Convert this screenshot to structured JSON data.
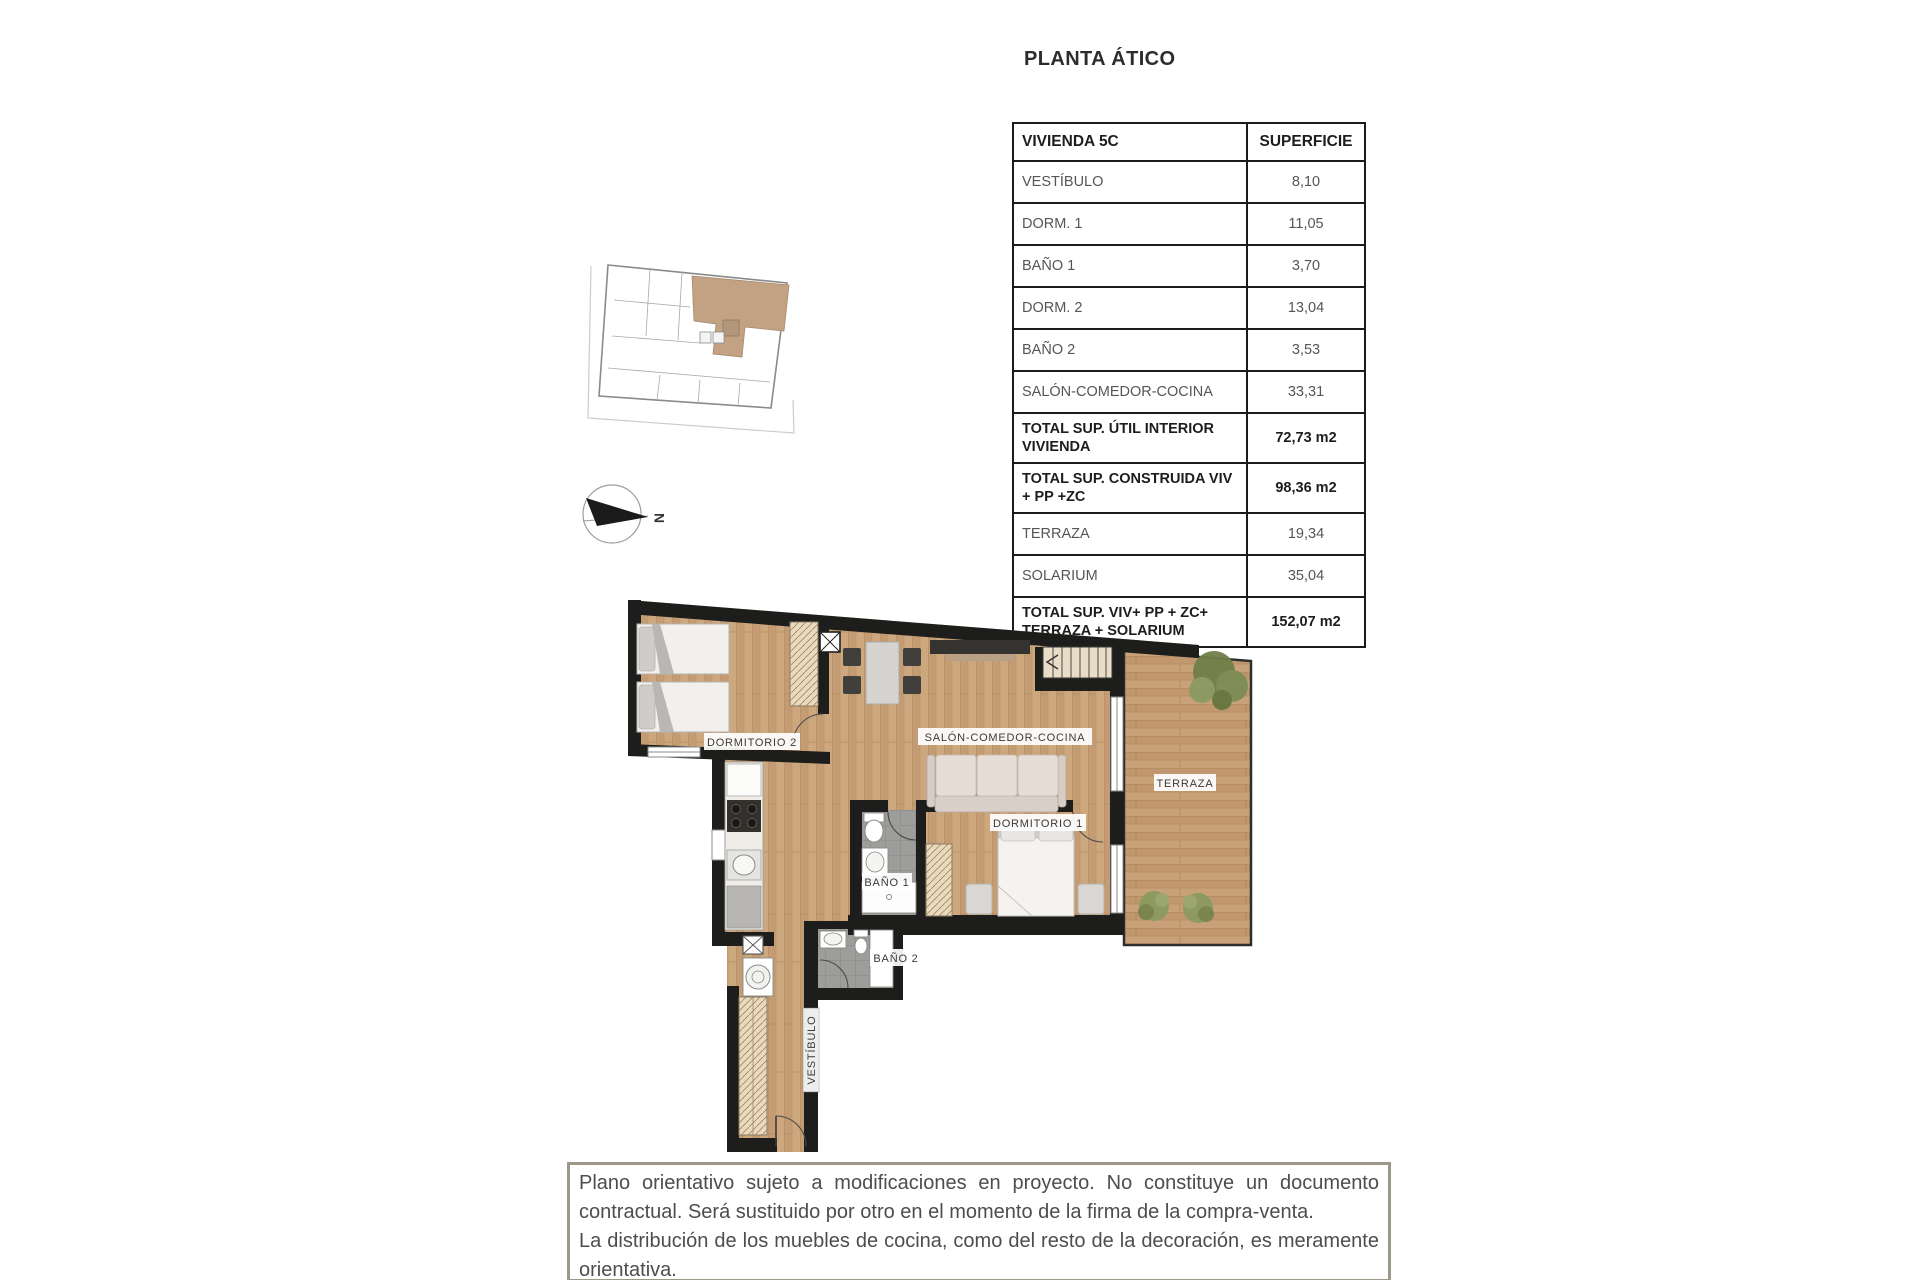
{
  "page": {
    "title": "PLANTA ÁTICO"
  },
  "table": {
    "header": [
      "VIVIENDA 5C",
      "SUPERFICIE"
    ],
    "rows": [
      {
        "label": "VESTÍBULO",
        "value": "8,10"
      },
      {
        "label": "DORM. 1",
        "value": "11,05"
      },
      {
        "label": "BAÑO 1",
        "value": "3,70"
      },
      {
        "label": "DORM. 2",
        "value": "13,04"
      },
      {
        "label": "BAÑO 2",
        "value": "3,53"
      },
      {
        "label": "SALÓN-COMEDOR-COCINA",
        "value": "33,31"
      },
      {
        "label": "TOTAL SUP. ÚTIL INTERIOR VIVIENDA",
        "value": "72,73 m2"
      },
      {
        "label": "TOTAL SUP. CONSTRUIDA VIV + PP +ZC",
        "value": "98,36 m2"
      },
      {
        "label": "TERRAZA",
        "value": "19,34"
      },
      {
        "label": "SOLARIUM",
        "value": "35,04"
      },
      {
        "label": "TOTAL SUP. VIV+ PP + ZC+ TERRAZA + SOLARIUM",
        "value": "152,07 m2"
      }
    ]
  },
  "plan": {
    "labels": {
      "dorm2": "DORMITORIO 2",
      "salon": "SALÓN-COMEDOR-COCINA",
      "terraza": "TERRAZA",
      "dorm1": "DORMITORIO 1",
      "bano1": "BAÑO 1",
      "bano2": "BAÑO 2",
      "vestibulo": "VESTÍBULO"
    }
  },
  "compass": {
    "north_label": "N"
  },
  "disclaimer": {
    "p1": "Plano orientativo sujeto a modificaciones en proyecto. No constituye un documento contractual. Será sustituido por otro en el momento de la firma de la compra-venta.",
    "p2": "La distribución de los muebles de cocina, como del resto de la decoración, es meramente orientativa."
  },
  "colors": {
    "wall": "#1d1d1b",
    "wood": "#cba47c",
    "unit_highlight": "#c3a183",
    "bath_tile": "#9d9d9b",
    "closet_wood": "#ead9bd",
    "plant_green": "#74834d",
    "disclaimer_border": "#9c998b",
    "table_border": "#1b1b1b"
  }
}
